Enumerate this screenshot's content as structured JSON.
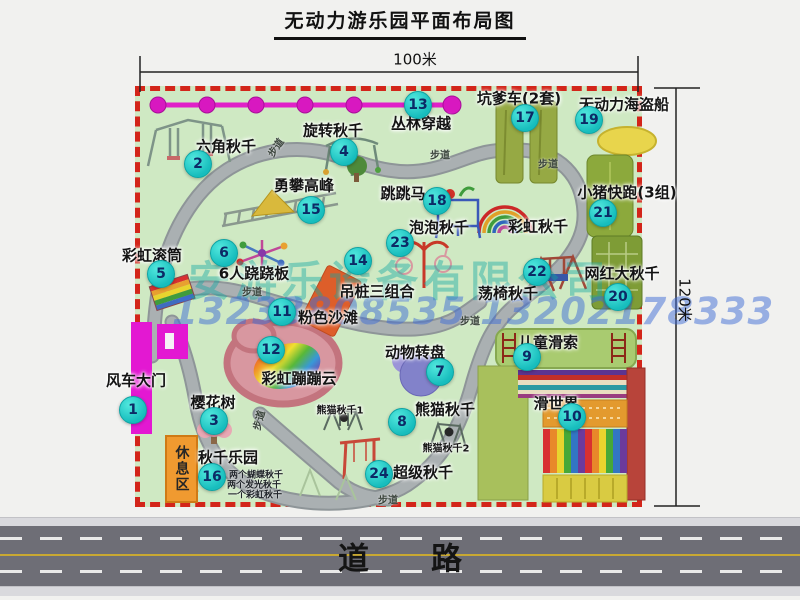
{
  "title": "无动力游乐园平面布局图",
  "dimensions": {
    "width": "100米",
    "height": "120米"
  },
  "road": {
    "label": "道　　路"
  },
  "watermark": {
    "company": "安游乐设备有限公司",
    "phone": "13233808535 13202178333"
  },
  "rest_area": {
    "label": "休息区"
  },
  "labels": {
    "path": "步道",
    "rainbow_swing": "彩虹秋千",
    "panda_swing_1": "熊猫秋千1",
    "panda_swing_2": "熊猫秋千2"
  },
  "swing_park_notes": [
    "两个蝴蝶秋千",
    "两个发光秋千",
    "一个彩虹秋千"
  ],
  "attractions": [
    {
      "num": "1",
      "label": "风车大门"
    },
    {
      "num": "2",
      "label": "六角秋千"
    },
    {
      "num": "3",
      "label": "樱花树"
    },
    {
      "num": "4",
      "label": "旋转秋千"
    },
    {
      "num": "5",
      "label": "彩虹滚筒"
    },
    {
      "num": "6",
      "label": "6人跷跷板"
    },
    {
      "num": "7",
      "label": "动物转盘"
    },
    {
      "num": "8",
      "label": "熊猫秋千"
    },
    {
      "num": "9",
      "label": "儿童滑索"
    },
    {
      "num": "10",
      "label": "滑世界"
    },
    {
      "num": "11",
      "label": "粉色沙滩"
    },
    {
      "num": "12",
      "label": "彩虹蹦蹦云"
    },
    {
      "num": "13",
      "label": "丛林穿越"
    },
    {
      "num": "14",
      "label": "吊桩三组合"
    },
    {
      "num": "15",
      "label": "勇攀高峰"
    },
    {
      "num": "16",
      "label": "秋千乐园"
    },
    {
      "num": "17",
      "label": "坑爹车(2套)"
    },
    {
      "num": "18",
      "label": "跳跳马"
    },
    {
      "num": "19",
      "label": "无动力海盗船"
    },
    {
      "num": "20",
      "label": "网红大秋千"
    },
    {
      "num": "21",
      "label": "小猪快跑(3组)"
    },
    {
      "num": "22",
      "label": "荡椅秋千"
    },
    {
      "num": "23",
      "label": "泡泡秋千"
    },
    {
      "num": "24",
      "label": "超级秋千"
    }
  ]
}
